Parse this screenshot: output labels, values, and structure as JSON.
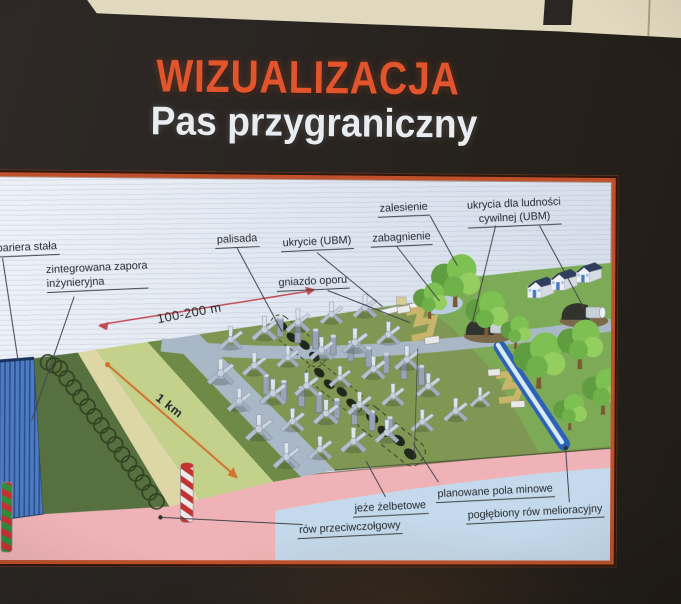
{
  "title": {
    "main": "WIZUALIZACJA",
    "subtitle": "Pas przygraniczny"
  },
  "diagram": {
    "labels": {
      "bariera_stala": "bariera stała",
      "zintegrowana_line1": "zintegrowana zapora",
      "zintegrowana_line2": "inżynieryjna",
      "palisada": "palisada",
      "ukrycie_ubm": "ukrycie (UBM)",
      "zabagnienie": "zabagnienie",
      "zalesienie": "zalesienie",
      "ukrycia_line1": "ukrycia dla ludności",
      "ukrycia_line2": "cywilnej (UBM)",
      "gniazdo_oporu": "gniazdo oporu",
      "dist_100_200": "100-200 m",
      "dist_1km": "1 km",
      "planowane_pola_minowe": "planowane pola minowe",
      "jeze_zelbetowe": "jeże żelbetowe",
      "row_przeciwczolgowy": "rów przeciwczołgowy",
      "poglebiony_row": "pogłębiony rów melioracyjny"
    },
    "colors": {
      "title_orange": "#e5532a",
      "subtitle_white": "#e9ecf1",
      "frame_orange": "#c1502a",
      "panel_background": "#e4eaf2",
      "field_green": "#7f9750",
      "berm_green": "#57703e",
      "anti_tank_pink": "#f0b3b7",
      "water_blue": "#c3d9ec",
      "barrier_blue": "#4d7cc4",
      "drainage_ditch_blue": "#2a62b8",
      "arrow_red": "#c34a53",
      "arrow_orange": "#d4722a"
    }
  }
}
